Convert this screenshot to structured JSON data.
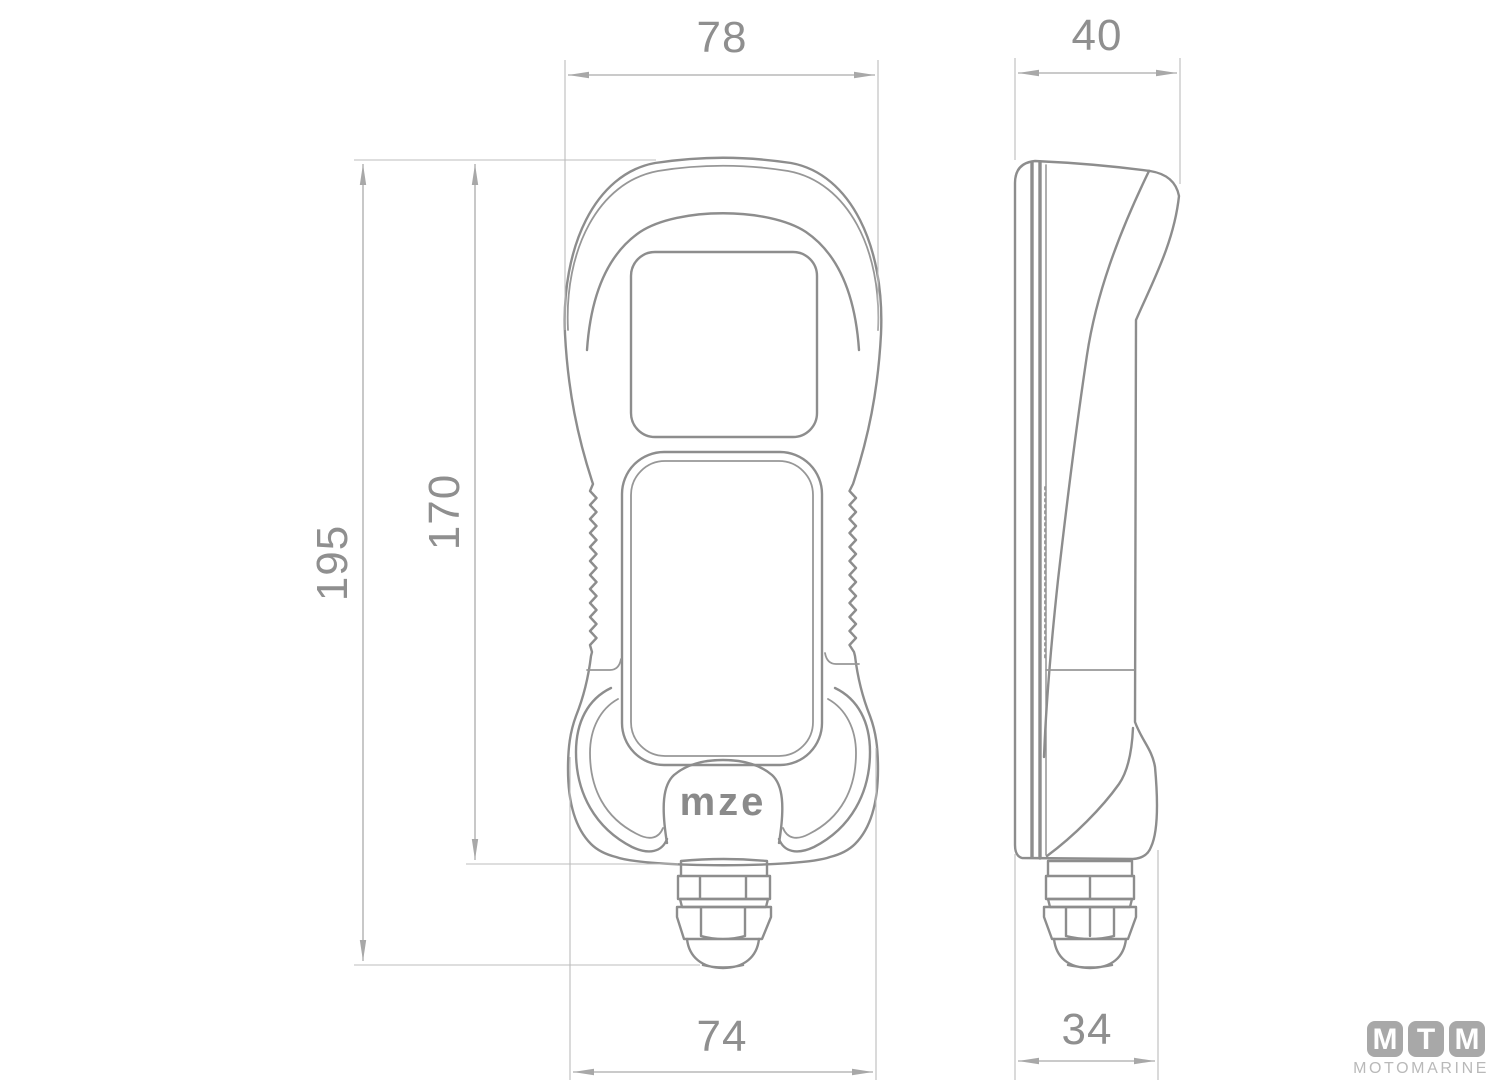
{
  "dimensions": {
    "front_top_width": "78",
    "side_top_depth": "40",
    "overall_height": "195",
    "body_height": "170",
    "front_bottom_width": "74",
    "side_bottom_depth": "34"
  },
  "device_logo": "mze",
  "watermark": {
    "letters": [
      "M",
      "T",
      "M"
    ],
    "name": "MOTOMARINE"
  },
  "colors": {
    "outline": "#8d8d8d",
    "dimension_line": "#ababab",
    "dimension_text": "#8f8f8f",
    "watermark_badge": "#a8a8a8",
    "watermark_text": "#b9b9b9"
  }
}
